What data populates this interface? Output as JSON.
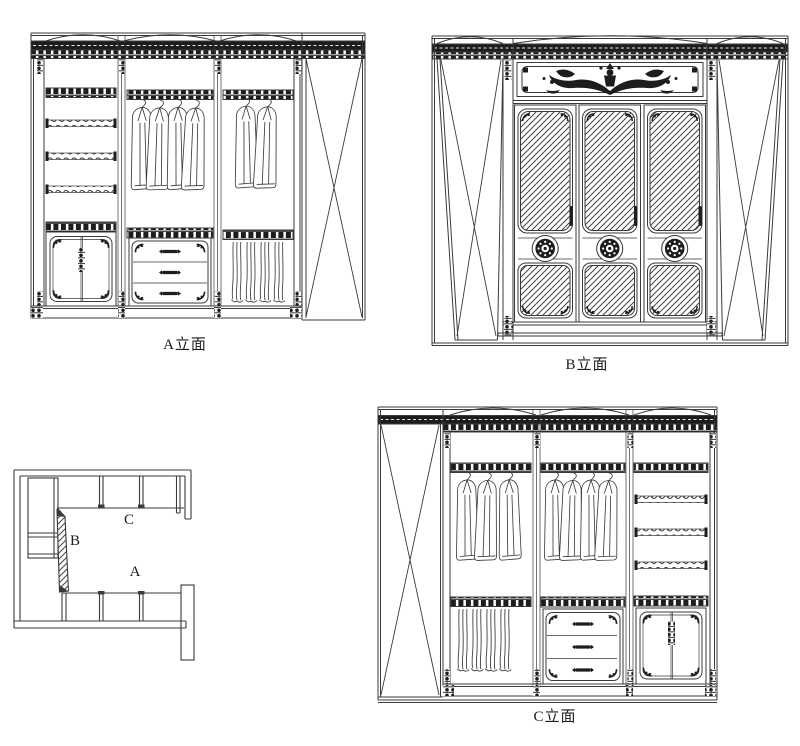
{
  "sheet": {
    "background": "#ffffff",
    "ink": "#3a3a3a",
    "dark_fill": "#1d1d1d",
    "hatch_color": "#454545"
  },
  "labels": {
    "elevation_a": "A立面",
    "elevation_b": "B立面",
    "elevation_c": "C立面"
  },
  "floor_plan": {
    "zone_a": "A",
    "zone_b": "B",
    "zone_c": "C"
  }
}
